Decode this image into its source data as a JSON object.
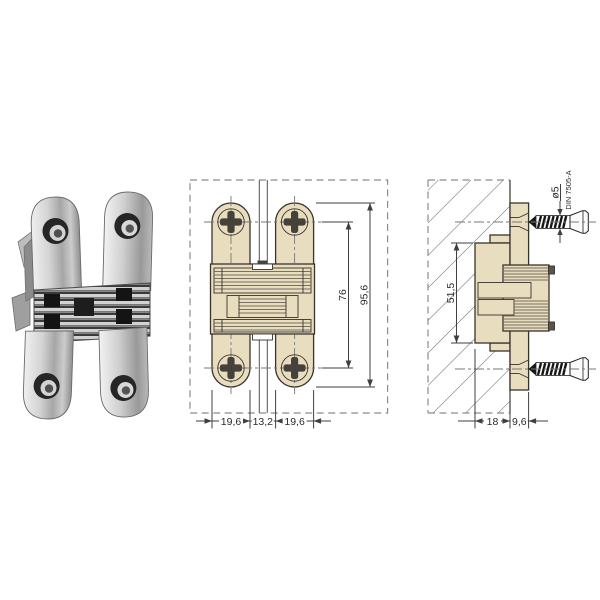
{
  "colors": {
    "background": "#ffffff",
    "drawing_fill": "#e9ddc0",
    "drawing_outline": "#38342c",
    "dimension_line": "#3f3f3f",
    "dashed_line": "#8c8c8c",
    "metal_light": "#ededed",
    "metal_dark": "#8f8f8f",
    "screw_dark": "#161616"
  },
  "front_view": {
    "width_left": "19,6",
    "width_center": "13,2",
    "width_right": "19,6",
    "hole_spacing": "76",
    "total_height": "95,6"
  },
  "side_view": {
    "mortise_depth": "18",
    "protrusion": "9,6",
    "body_height": "51,5",
    "screw_diameter": "ø5",
    "screw_standard": "DIN 7505-A"
  }
}
